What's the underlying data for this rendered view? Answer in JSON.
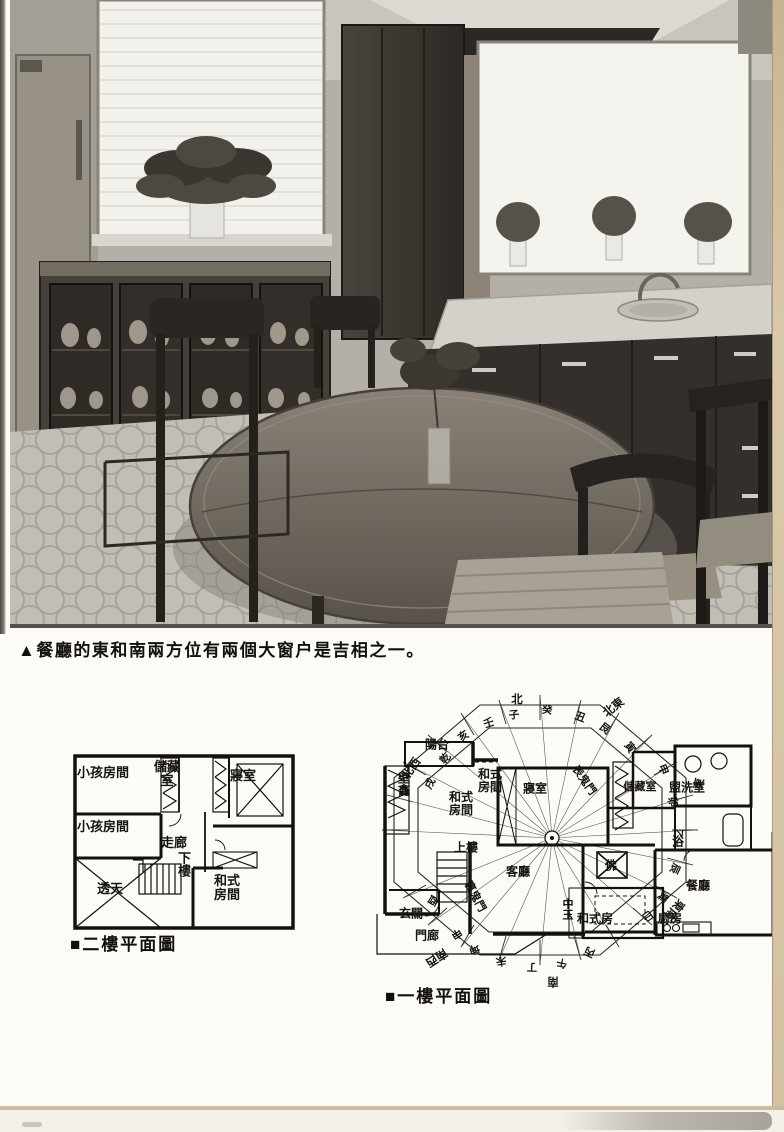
{
  "page": {
    "photo_caption": "▲餐廳的東和南兩方位有兩個大窗户是吉相之一。"
  },
  "plan2f": {
    "title": "■二樓平面圖",
    "rooms": {
      "kids_room_1": "小孩房間",
      "storage": "儲藏室",
      "bedroom": "寢室",
      "kids_room_2": "小孩房間",
      "corridor": "走廊",
      "stairs_down": "下樓",
      "void": "透天",
      "japanese_room": "和式房間"
    }
  },
  "plan1f": {
    "title": "■一樓平面圖",
    "rooms": {
      "balcony": "陽台",
      "alcove": "壁龕",
      "japanese_room_a": "和式房間",
      "japanese_room_b": "和式房間",
      "bedroom": "寢室",
      "storage": "儲藏室",
      "washroom": "盥洗室",
      "bath": "浴",
      "dining": "餐廳",
      "kitchen": "廚房",
      "living": "客廳",
      "entry": "玄關",
      "porch": "門廊",
      "stairs_up": "上樓",
      "altar": "佛",
      "japanese_room_c": "和式房",
      "center_pillar": "中玉"
    },
    "fengshui": {
      "front_demon_gate": "表鬼門",
      "back_demon_gate": "裏鬼門"
    },
    "compass": {
      "directions": {
        "n": "北",
        "ne": "北東",
        "e": "東",
        "se": "東南",
        "s": "南",
        "sw": "南西",
        "nw": "北西"
      },
      "ring": [
        "壬",
        "子",
        "癸",
        "丑",
        "艮",
        "寅",
        "甲",
        "卯",
        "乙",
        "辰",
        "巽",
        "巳",
        "丙",
        "午",
        "丁",
        "未",
        "坤",
        "申",
        "酉",
        "戌",
        "乾",
        "亥"
      ]
    }
  }
}
